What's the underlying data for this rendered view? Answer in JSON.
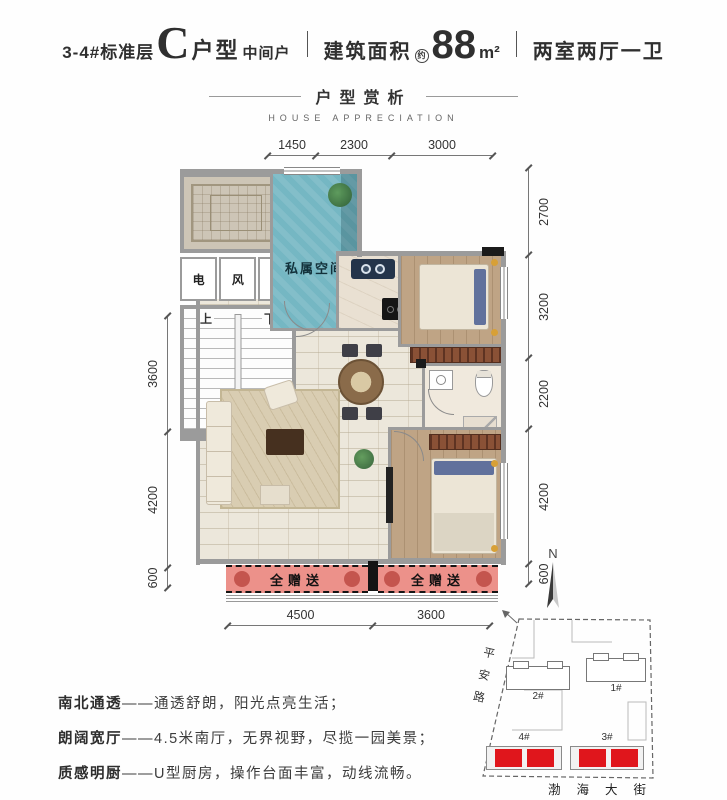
{
  "header": {
    "prefix": "3-4#标准层",
    "unit_letter": "C",
    "unit_word": "户型",
    "position": "中间户",
    "area_label": "建筑面积",
    "area_approx": "约",
    "area_value": "88",
    "area_unit": "m²",
    "rooms": "两室两厅一卫"
  },
  "section": {
    "title": "户型赏析",
    "subtitle": "HOUSE APPRECIATION"
  },
  "plan": {
    "dims_top": [
      "1450",
      "2300",
      "3000"
    ],
    "dims_left": [
      "3600",
      "4200",
      "600"
    ],
    "dims_right": [
      "2700",
      "3200",
      "2200",
      "4200",
      "600"
    ],
    "dims_bottom": [
      "4500",
      "3600"
    ],
    "room_labels": {
      "private_space": "私属空间",
      "electric": "电",
      "vent": "风",
      "plumbing": "水暖",
      "stairs_up": "上",
      "stairs_down": "下"
    },
    "gift_labels": [
      "全赠送",
      "全赠送"
    ],
    "compass_label": "N"
  },
  "features": [
    {
      "label": "南北通透",
      "sep": "——",
      "text": "通透舒朗，阳光点亮生活；"
    },
    {
      "label": "朗阔宽厅",
      "sep": "——",
      "text": "4.5米南厅，无界视野，尽揽一园美景；"
    },
    {
      "label": "质感明厨",
      "sep": "——",
      "text": "U型厨房，操作台面丰富，动线流畅。"
    }
  ],
  "sitemap": {
    "road_left": "平安路",
    "road_bottom": "渤海大街",
    "buildings": [
      {
        "id": "2#",
        "highlighted": false
      },
      {
        "id": "1#",
        "highlighted": false
      },
      {
        "id": "4#",
        "highlighted": true
      },
      {
        "id": "3#",
        "highlighted": true
      }
    ]
  },
  "colors": {
    "private_space_teal": "#75b7c3",
    "gift_area_red": "#ec918a",
    "highlight_building_red": "#e0161c",
    "wall_gray": "#9b9b9b",
    "wood_floor": "#bfa485",
    "text_dark": "#2f2f2f"
  }
}
